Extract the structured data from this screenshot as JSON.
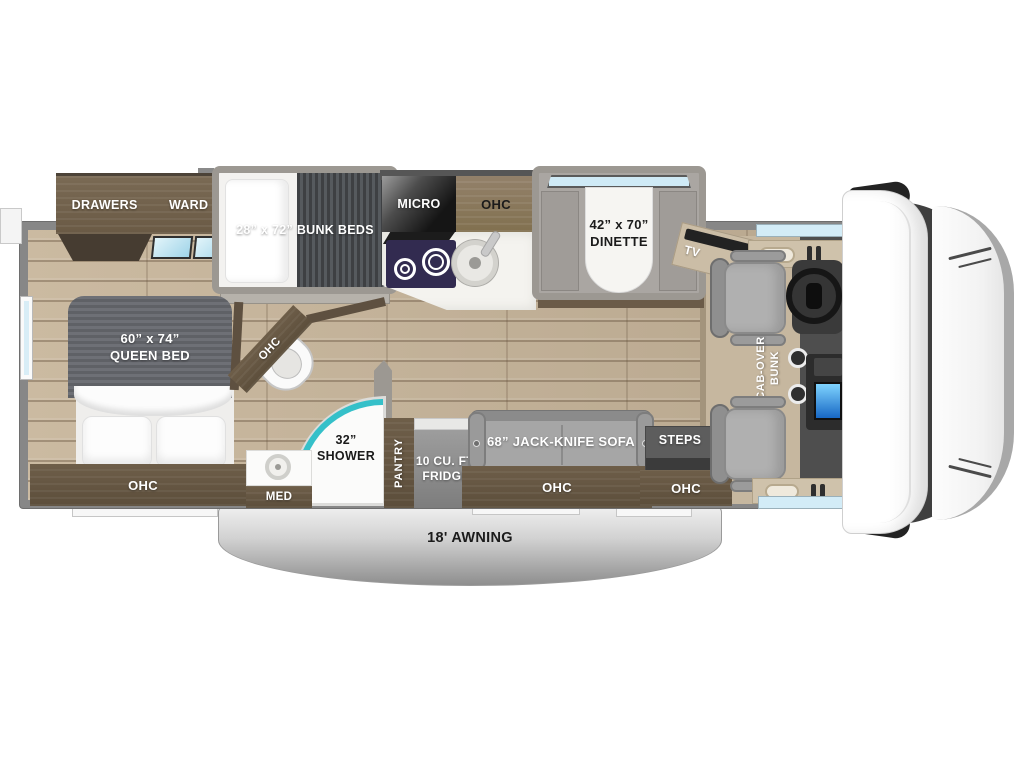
{
  "bedroom": {
    "drawers": "DRAWERS",
    "ward": "WARD",
    "bed_size": "60” x 74”",
    "bed_name": "QUEEN BED",
    "ohc": "OHC"
  },
  "bunk_room": {
    "bunk_beds": "28” x 72” BUNK BEDS"
  },
  "kitchen": {
    "micro": "MICRO",
    "ohc": "OHC",
    "pantry": "PANTRY",
    "fridge_line1": "10 CU. FT.",
    "fridge_line2": "FRIDGE"
  },
  "dinette": {
    "size": "42” x 70”",
    "name": "DINETTE"
  },
  "bathroom": {
    "corner_ohc": "OHC",
    "shower_size": "32”",
    "shower_name": "SHOWER",
    "med": "MED"
  },
  "living": {
    "sofa": "68” JACK-KNIFE SOFA",
    "sofa_ohc": "OHC",
    "steps": "STEPS",
    "entry_ohc": "OHC",
    "tv": "TV"
  },
  "cab": {
    "bunk_line1": "CAB-OVER",
    "bunk_line2": "BUNK"
  },
  "exterior": {
    "awning": "18' AWNING"
  },
  "colors": {
    "accent_teal": "#35c0c9",
    "window_blue": "#cfeaf6",
    "floor_wood": "#c5b49b",
    "cabinet_brown": "#75654f",
    "wall_gray": "#878787",
    "slide_gray": "#9c9892"
  }
}
